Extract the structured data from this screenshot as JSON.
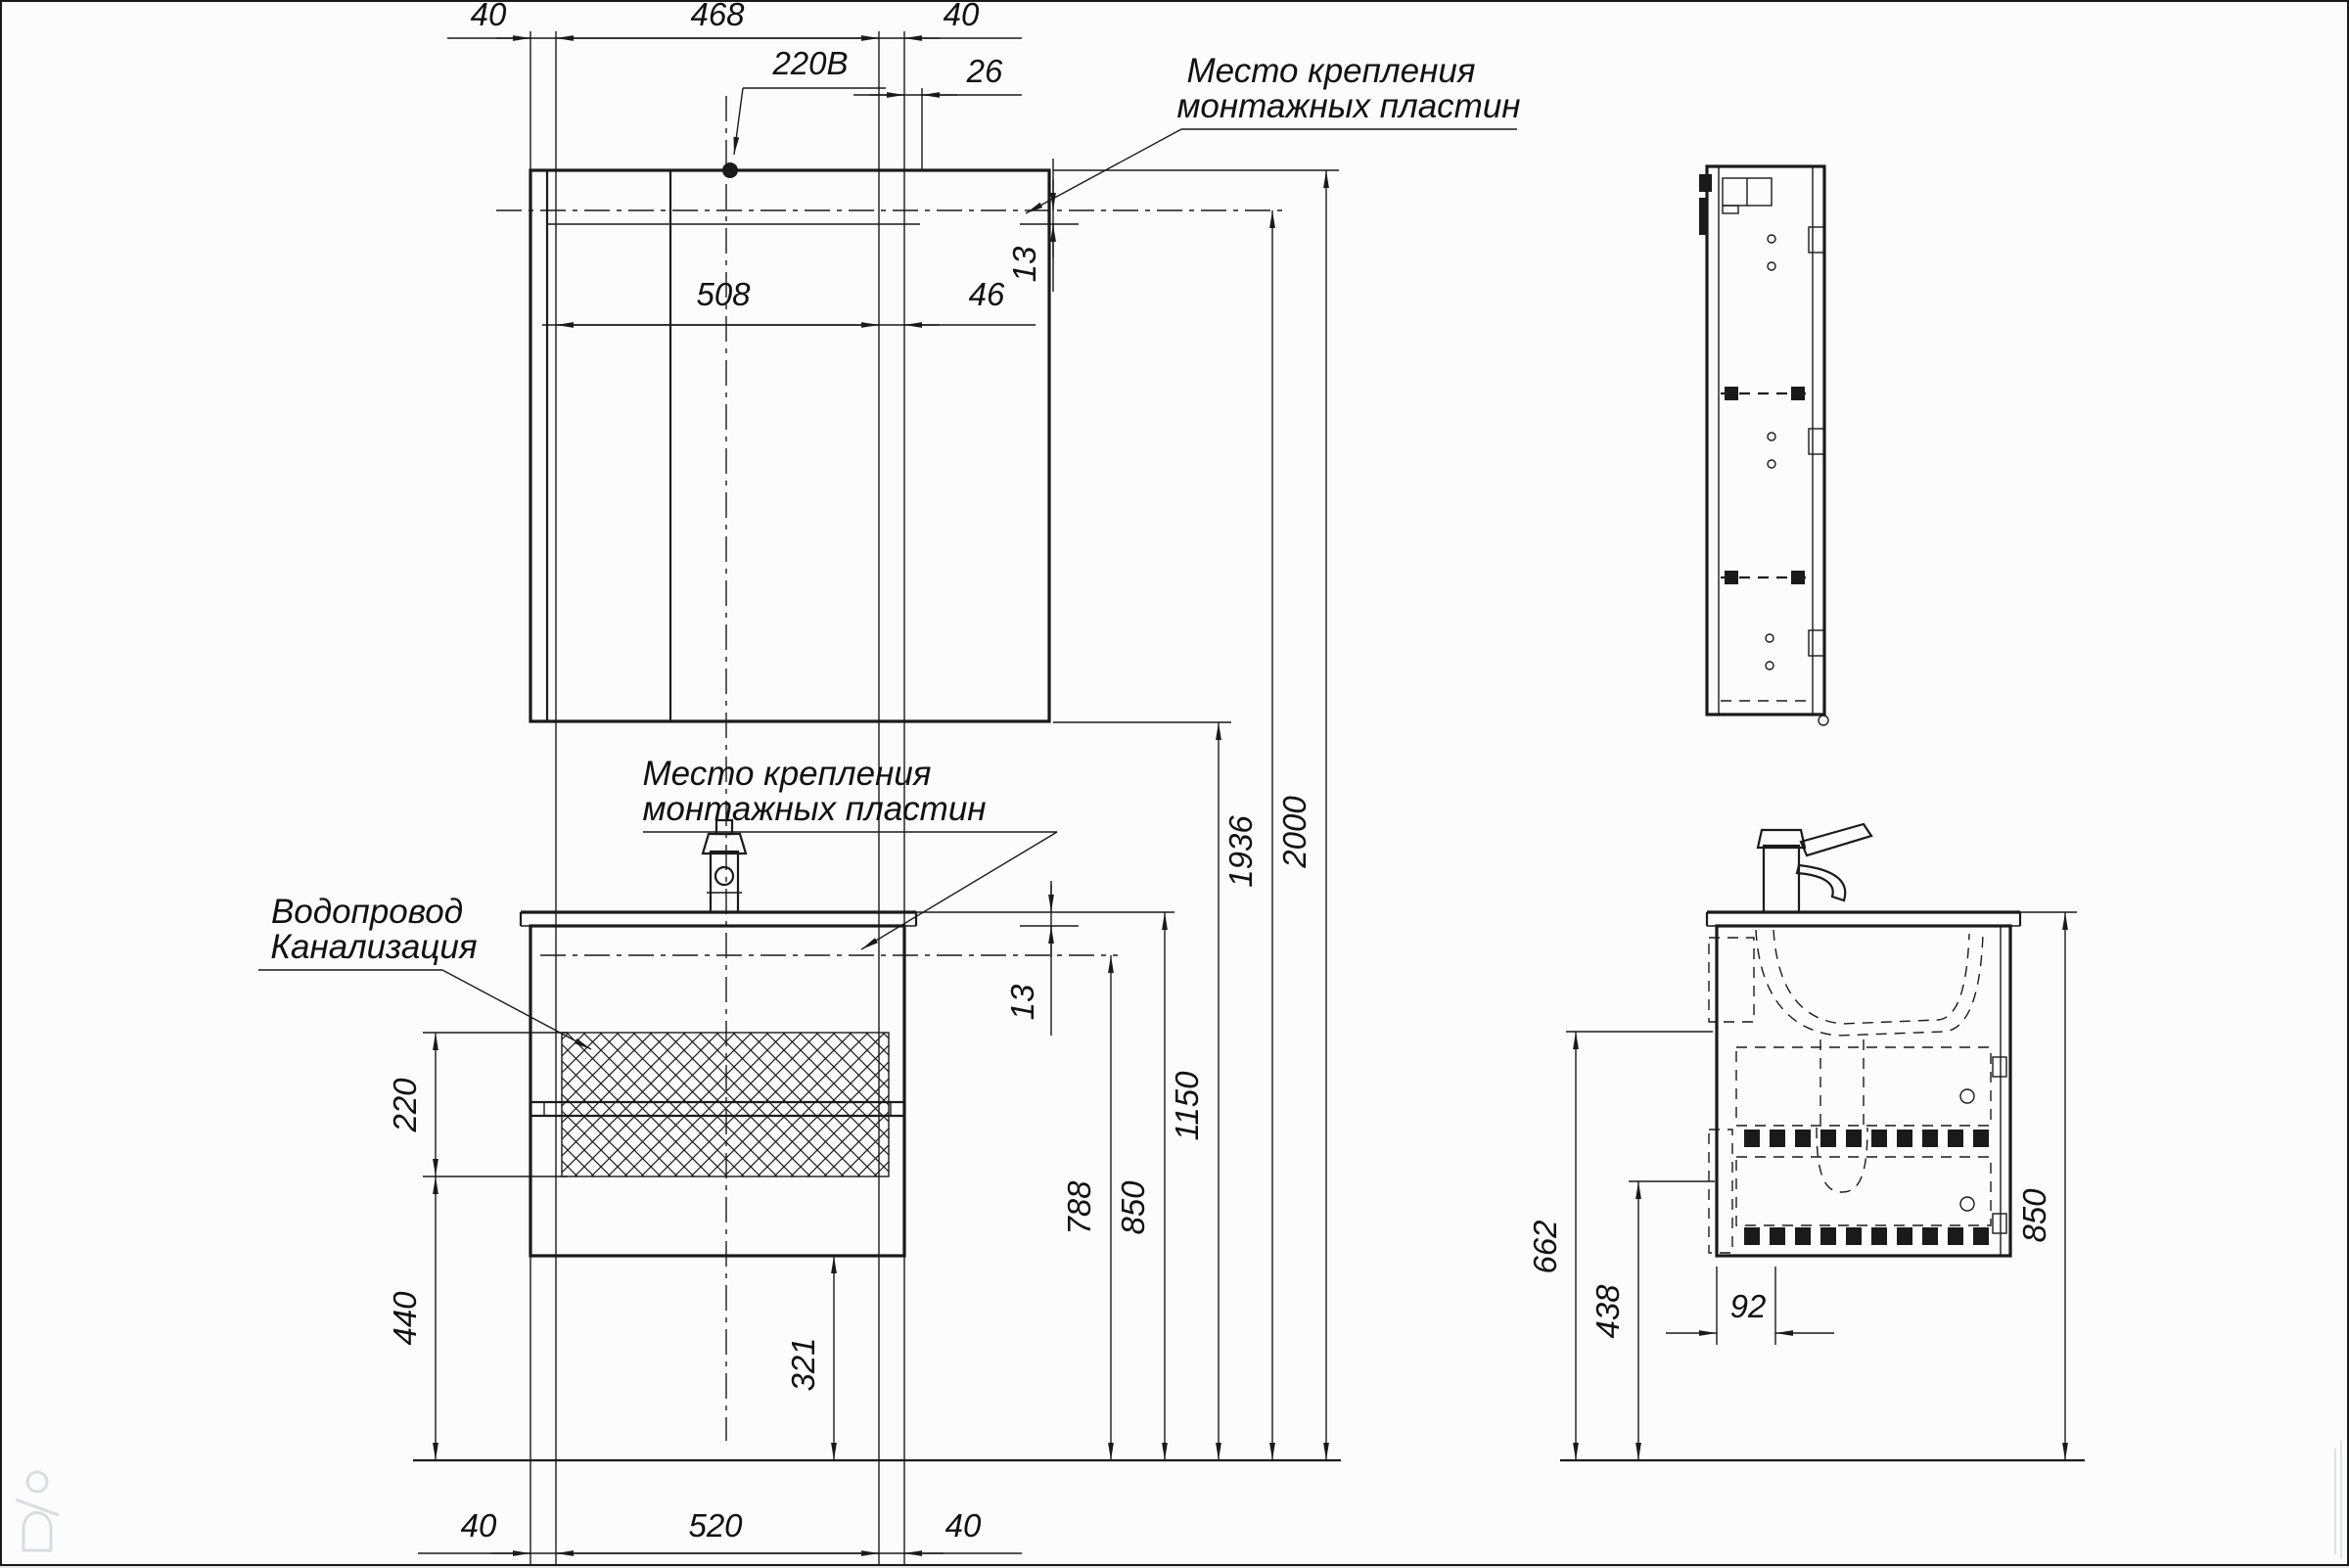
{
  "colors": {
    "line": "#1a1a1a",
    "background": "#fcfcfc",
    "watermark": "#b9c3cb"
  },
  "notes": {
    "mounting_top_line1": "Место крепления",
    "mounting_top_line2": "монтажных пластин",
    "mounting_mid_line1": "Место крепления",
    "mounting_mid_line2": "монтажных пластин",
    "plumbing_line1": "Водопровод",
    "plumbing_line2": "Канализация",
    "power_label": "220В"
  },
  "dims": {
    "top_left_40": "40",
    "top_468": "468",
    "top_right_40": "40",
    "top_26": "26",
    "mirror_508": "508",
    "mirror_46": "46",
    "mirror_top_13": "13",
    "left_220": "220",
    "left_440": "440",
    "bottom_left_40": "40",
    "bottom_520": "520",
    "bottom_right_40": "40",
    "vanity_13": "13",
    "height_788": "788",
    "height_850": "850",
    "height_1150": "1150",
    "height_1936": "1936",
    "height_2000": "2000",
    "floor_321": "321",
    "side_662": "662",
    "side_438": "438",
    "side_92": "92",
    "side_850": "850"
  }
}
